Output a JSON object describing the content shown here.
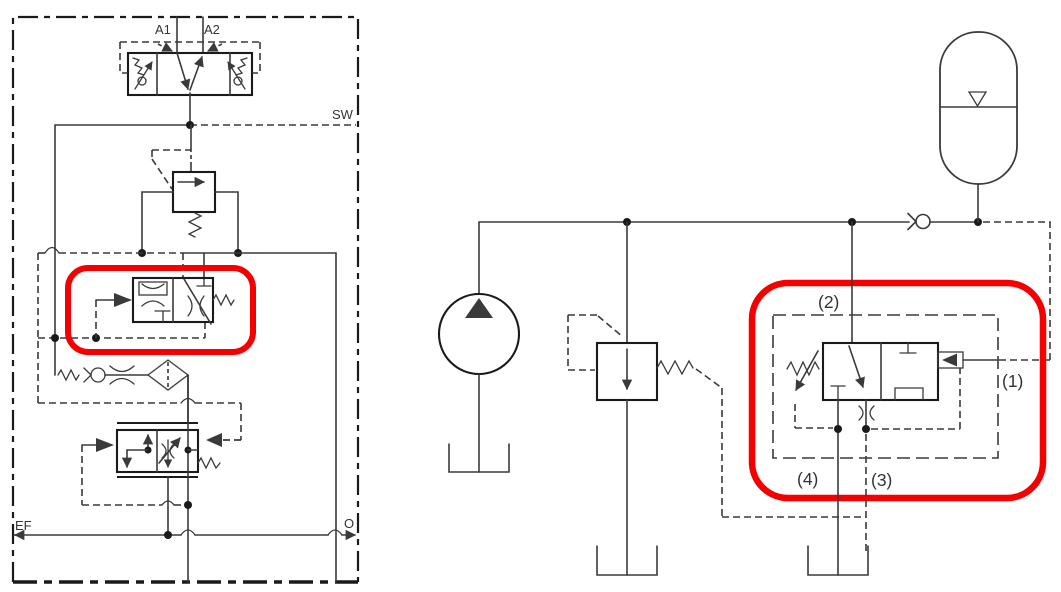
{
  "document": {
    "type": "hydraulic-schematic-figure",
    "left_schematic": {
      "description": "valve block circuit with highlighted pressure compensator",
      "labels": {
        "a1": "A1",
        "a2": "A2",
        "sw": "SW",
        "ef": "EF",
        "o": "O"
      }
    },
    "right_schematic": {
      "description": "pump accumulator charging circuit with highlighted unloading valve",
      "labels": {
        "n1": "(1)",
        "n2": "(2)",
        "n3": "(3)",
        "n4": "(4)"
      }
    }
  },
  "colors": {
    "highlight": "#f40000",
    "line": "#3a3a3a",
    "dark": "#1a1a1a",
    "text": "#333333",
    "bg": "#ffffff"
  }
}
